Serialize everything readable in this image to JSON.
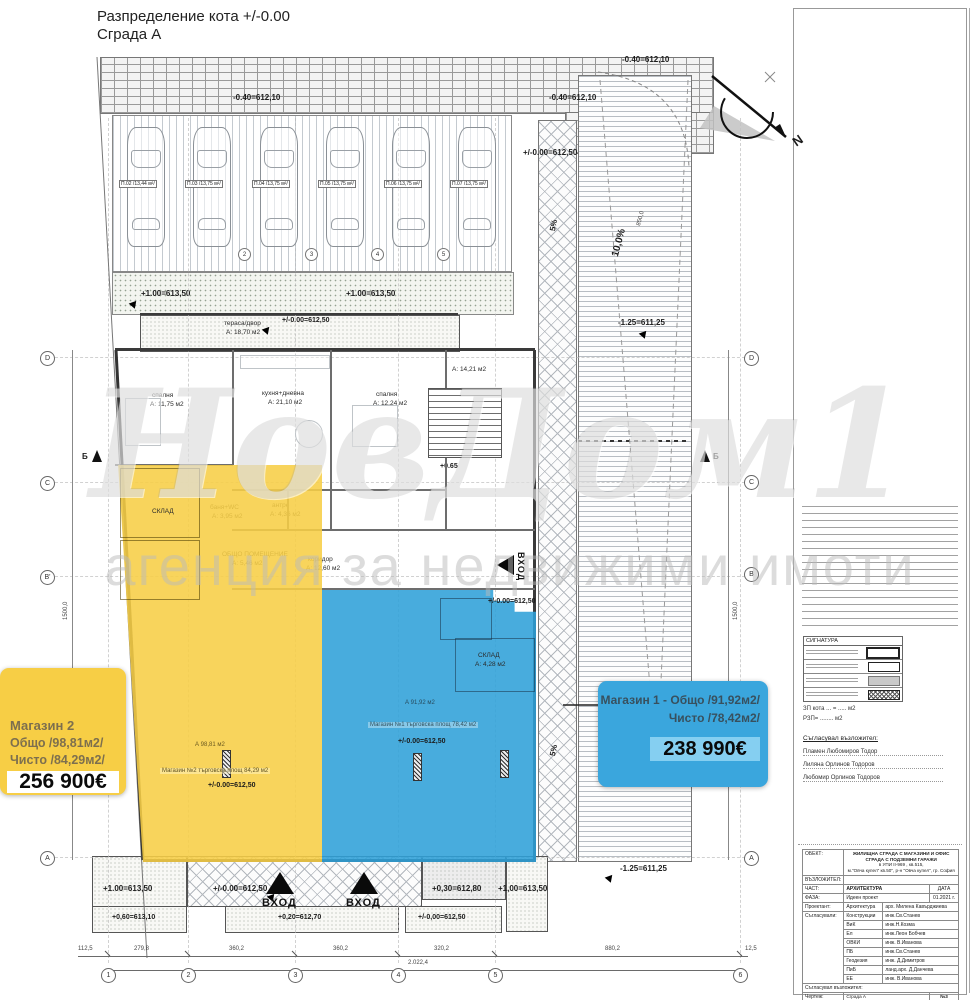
{
  "title": {
    "line1": "Разпределение  кота +/-0.00",
    "line2": "Сграда А"
  },
  "watermark": {
    "brand": "НовДом1",
    "tagline": "агенция за недвижими имоти"
  },
  "north": {
    "label": "N"
  },
  "parking": {
    "spots": [
      "П.02 /13,44 м²/",
      "П.03 /13,75 м²/",
      "П.04 /13,75 м²/",
      "П.05 /13,75 м²/",
      "П.06 /13,75 м²/",
      "П.07 /13,75 м²/"
    ],
    "numbers": [
      "2",
      "3",
      "4",
      "5"
    ]
  },
  "elevations": {
    "top_left": "-0.40=612,10",
    "top_mid": "-0.40=612,10",
    "top_right": "-0.40=612,10",
    "ramp_upper": "+/-0.00=612,50",
    "garden_left": "+1.00=613,50",
    "garden_right": "+1.00=613,50",
    "terrace": "+/-0.00=612,50",
    "stair": "+0.65",
    "ramp_mid": "-1.25=611,25",
    "ramp_low": "-1.25=611,25",
    "side_entry": "+/-0.00=612,50",
    "shop1": "+/-0.00=612,50",
    "shop2": "+/-0.00=612,50",
    "bottom_left": "+1.00=613,50",
    "bottom_walk": "+/-0.00=612,50",
    "bottom_mid": "+0,30=612,80",
    "bottom_right": "+1,00=613,50",
    "curb_left": "+0,60=613,10",
    "curb_mid": "+0,20=612,70",
    "curb_right": "+/-0,00=612,50"
  },
  "slopes": {
    "ped_top": "5%",
    "ped_bottom": "5%",
    "car_ramp": "10,0%"
  },
  "rooms": {
    "terrace_name": "тераса/двор",
    "terrace_area": "А: 18,70 м2",
    "bedroom1_name": "спалня",
    "bedroom1_area": "А: 11,75 м2",
    "kitchen_name": "кухня+дневна",
    "kitchen_area": "А: 21,10 м2",
    "bedroom2_name": "спалня",
    "bedroom2_area": "А: 12,24 м2",
    "stair_area": "А: 14,21 м2",
    "bath_name": "баня+WC",
    "bath_area": "А: 3,95 м2",
    "hall_name": "антре",
    "hall_area": "А: 4,36 м2",
    "common_name": "общо помещение",
    "common_area": "А: 5,46 м2",
    "corridor_name": "коридор",
    "corridor_area": "А: 12,60 м2",
    "store2": "склад",
    "store1_name": "склад",
    "store1_area": "А: 4,28 м2"
  },
  "shops": {
    "shop2_area": "А 98,81 м2",
    "shop2_band": "Магазин №2 търговска площ 84,29 м2",
    "shop1_area": "А 91,92 м2",
    "shop1_band": "Магазин №1 търговска площ 78,42 м2"
  },
  "entrances": {
    "front1": "ВХОД",
    "front2": "ВХОД",
    "side": "ВХОД"
  },
  "grid": {
    "bottom": [
      "1",
      "2",
      "3",
      "4",
      "5",
      "6"
    ],
    "left": [
      "D",
      "C",
      "B'",
      "A"
    ],
    "right": [
      "D",
      "C",
      "B",
      "A"
    ],
    "section": "Б"
  },
  "dims": {
    "bottom": [
      "112,5",
      "279,8",
      "360,2",
      "360,2",
      "320,2",
      "880,2",
      "12,5"
    ],
    "total": "2.022,4",
    "left_v": "1500,0",
    "right_v": "1500,0",
    "ramp_v": "850,0"
  },
  "cards": {
    "shop2": {
      "title": "Магазин 2",
      "gross": "Общо /98,81м2/",
      "net": "Чисто /84,29м2/",
      "price": "256 900€"
    },
    "shop1": {
      "title": "Магазин 1 - Общо /91,92м2/",
      "net": "Чисто /78,42м2/",
      "price": "238 990€"
    }
  },
  "panel": {
    "legend_title": "СИГНАТУРА",
    "zp": "ЗП кота ... = ..... м2",
    "rzp": "РЗП= ........ м2",
    "approved_title": "Съгласувал възложител:",
    "approved": [
      "Пламен Любомиров Тодор",
      "Лиляна Орлинов Тодоров",
      "Любомир Орлинов Тодоров"
    ],
    "tb": {
      "object_label": "ОБЕКТ:",
      "object_lines": [
        "ЖИЛИЩНА СГРАДА С МАГАЗИНИ И ОФИС",
        "СГРАДА С ПОДЗЕМНИ ГАРАЖИ",
        "в УПИ II-969 , кв.515,",
        "м.\"Овча купел\" кв.50\", р-н \"Овча купел\", гр. София"
      ],
      "client_label": "ВЪЗЛОЖИТЕЛ:",
      "part_label": "ЧАСТ:",
      "part": "АРХИТЕКТУРА",
      "date_label": "ДАТА",
      "phase_label": "ФАЗА:",
      "phase": "Идеен проект",
      "date": "01.2021 г.",
      "designer_label": "Проектант:",
      "coord_label": "Съгласували:",
      "rows": [
        [
          "Архитектура",
          "арх. Милена Кавърджиева"
        ],
        [
          "Конструкции",
          "инж.Св.Станев"
        ],
        [
          "ВиК",
          "инж.Н.Козма"
        ],
        [
          "Ел",
          "инж.Леон Бобчев"
        ],
        [
          "ОВКИ",
          "инж. В.Иванова"
        ],
        [
          "ПБ",
          "инж.Св.Станев"
        ],
        [
          "Геодезия",
          "инж. Д.Димитров"
        ],
        [
          "ПиБ",
          "ланд.арх. Д.Данчева"
        ],
        [
          "ЕЕ",
          "инж. В.Иванова"
        ]
      ],
      "client_sign": "Съгласувал възложител:",
      "drawing_label": "Чертеж:",
      "drawing1": "Сграда А",
      "drawing2": "Разпределение кота +/-0.00",
      "number": "№3",
      "scale": "М 1:50"
    }
  }
}
